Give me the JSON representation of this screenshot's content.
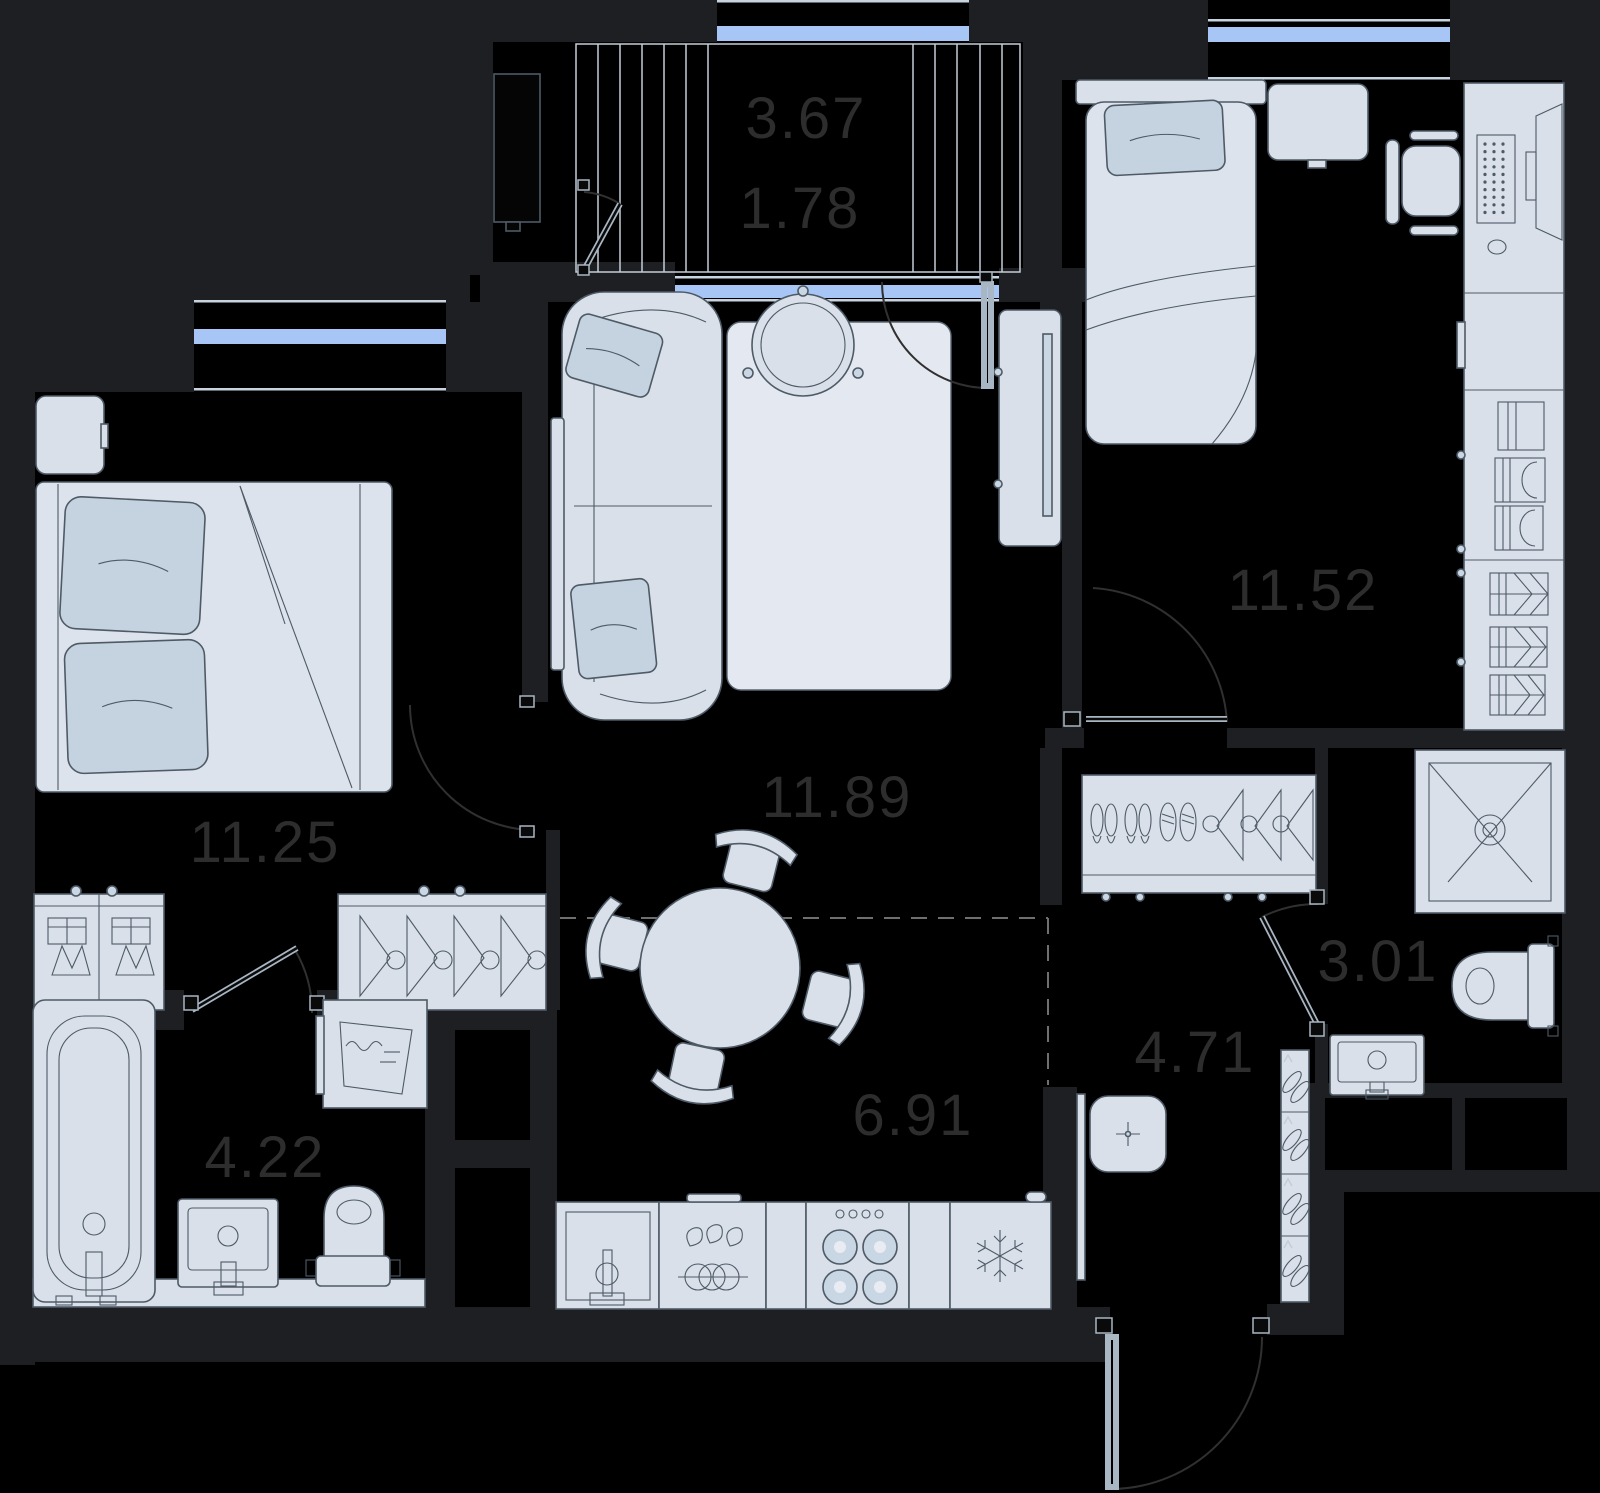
{
  "plan": {
    "type": "apartment-floor-plan",
    "colors": {
      "background": "#000000",
      "wall": "#1d1f22",
      "window_accent": "#a7c6f6",
      "furniture_fill": "#d9e0ea",
      "furniture_stroke": "#4e5a66",
      "pillow_fill": "#c5d3e1",
      "label_text": "#2d2d2d"
    }
  },
  "rooms": [
    {
      "id": "loggia",
      "name": "loggia/balcony",
      "labels": [
        "3.67",
        "1.78"
      ]
    },
    {
      "id": "bedroom-2",
      "name": "bedroom",
      "area": "11.52"
    },
    {
      "id": "living-room",
      "name": "living room",
      "area": "11.89"
    },
    {
      "id": "bedroom-1",
      "name": "bedroom",
      "area": "11.25"
    },
    {
      "id": "kitchen",
      "name": "kitchen-dining",
      "area": "6.91"
    },
    {
      "id": "hallway",
      "name": "hallway",
      "area": "4.71"
    },
    {
      "id": "bathroom",
      "name": "bathroom",
      "area": "4.22"
    },
    {
      "id": "shower-room",
      "name": "shower room",
      "area": "3.01"
    }
  ]
}
